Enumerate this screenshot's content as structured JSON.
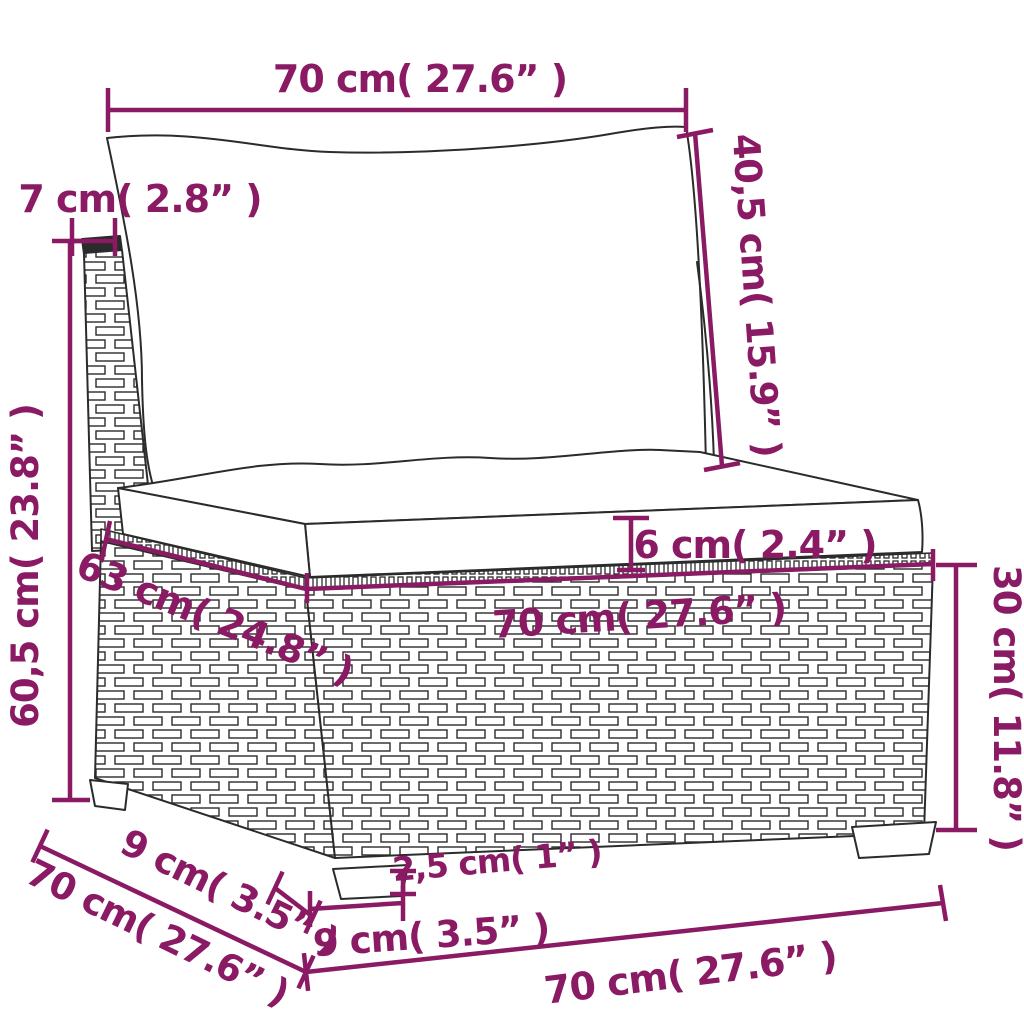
{
  "diagram": {
    "kind": "product-dimension-diagram",
    "subject": "rattan-sofa-middle-section-with-cushions",
    "accent_color": "#8a1a63",
    "line_color": "#2b2b2b",
    "background_color": "#ffffff",
    "labels": {
      "back_cushion_width": "70 cm( 27.6” )",
      "back_cushion_height": "40,5 cm( 15.9” )",
      "back_panel_thickness": "7 cm( 2.8” )",
      "total_height": "60,5 cm( 23.8” )",
      "seat_cushion_thickness": "6 cm( 2.4” )",
      "seat_width": "70 cm( 27.6” )",
      "seat_depth": "63 cm( 24.8” )",
      "base_height": "30 cm( 11.8” )",
      "total_depth": "70 cm( 27.6” )",
      "foot_depth": "9 cm( 3.5” )",
      "foot_width": "9 cm( 3.5” )",
      "foot_height": "2,5 cm( 1” )",
      "base_width": "70 cm( 27.6” )"
    }
  }
}
